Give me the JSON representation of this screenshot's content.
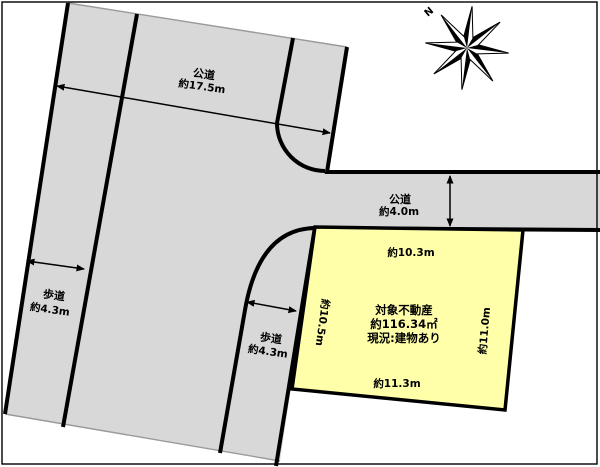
{
  "map": {
    "compass_label": "N",
    "roads": {
      "top_road_name": "公道",
      "top_road_width": "約17.5m",
      "right_road_name": "公道",
      "right_road_width": "約4.0m",
      "left_sidewalk_name": "歩道",
      "left_sidewalk_width": "約4.3m",
      "right_sidewalk_name": "歩道",
      "right_sidewalk_width": "約4.3m"
    },
    "plot": {
      "title": "対象不動産",
      "area": "約116.34㎡",
      "status": "現況:建物あり",
      "edge_top": "約10.3m",
      "edge_bottom": "約11.3m",
      "edge_left": "約10.5m",
      "edge_right": "約11.0m"
    },
    "colors": {
      "road_fill": "#d8d8d8",
      "plot_fill": "#ffffaa",
      "line": "#000000",
      "background": "#ffffff"
    }
  }
}
